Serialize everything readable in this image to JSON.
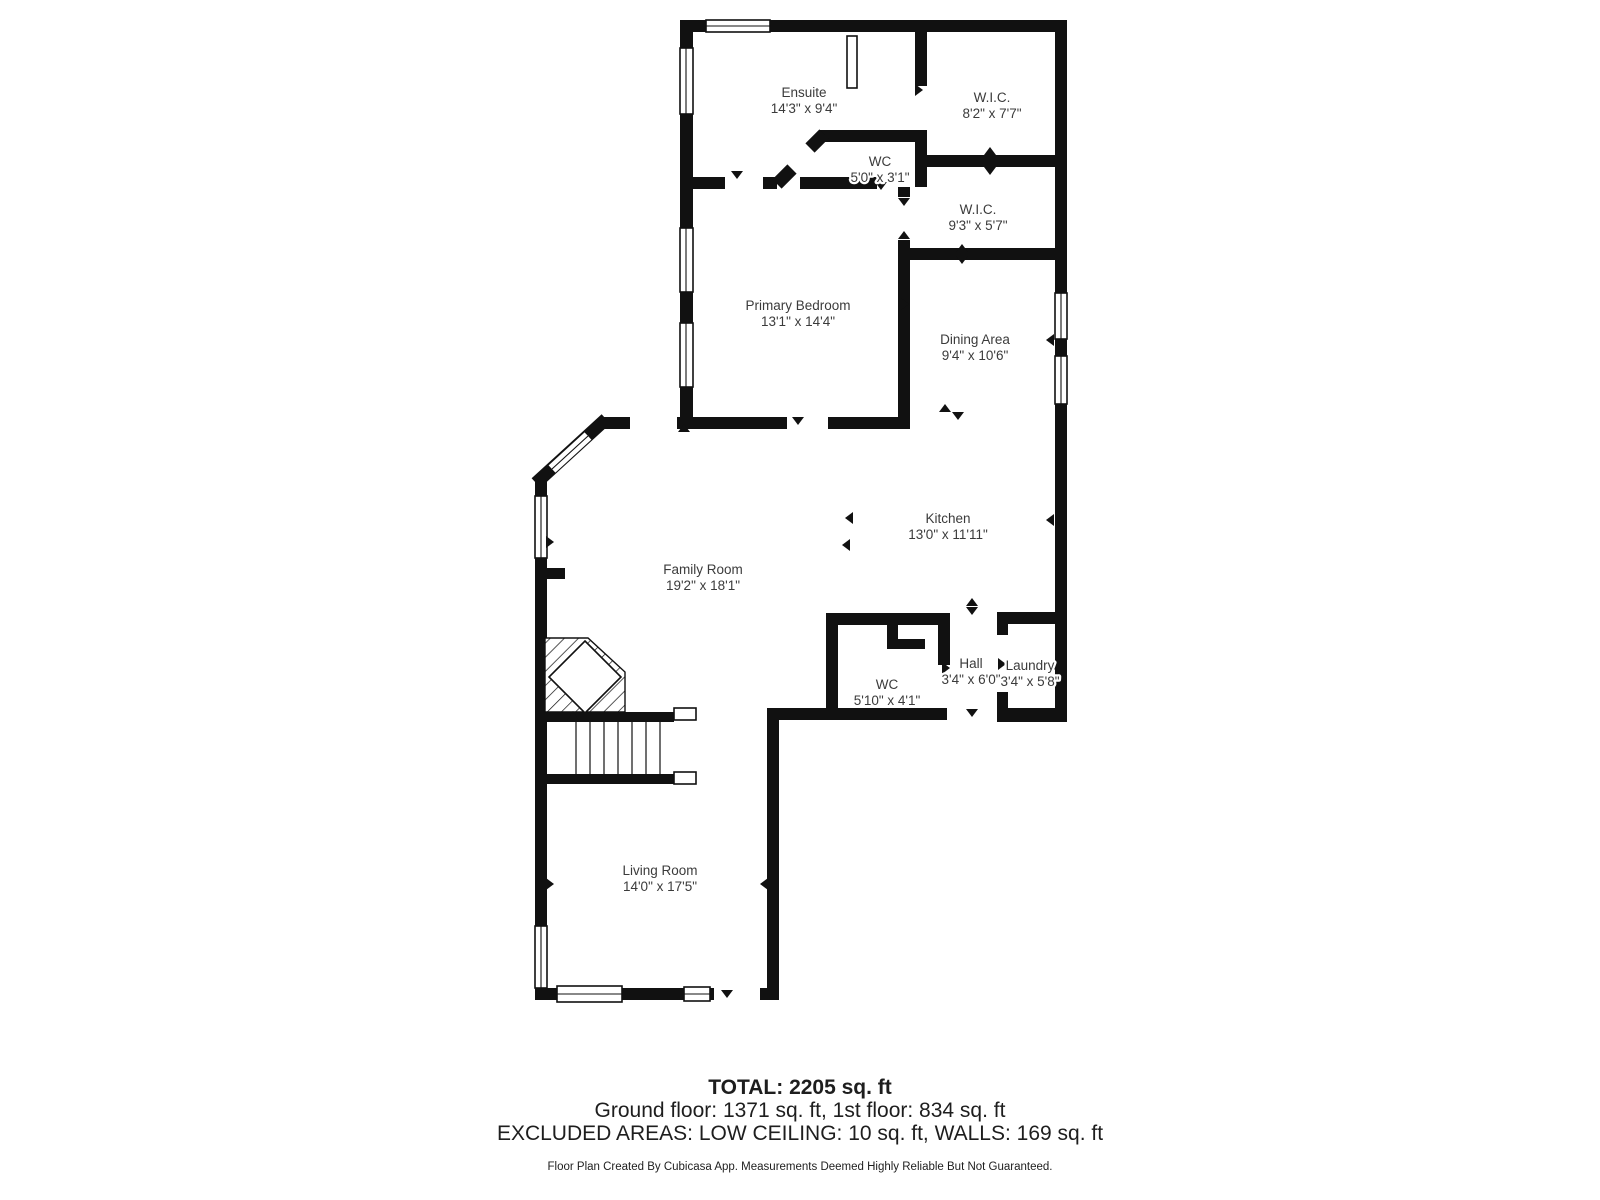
{
  "floorplan": {
    "colors": {
      "wall_color": "#111111",
      "label_color": "#3b3b3b",
      "footer_color": "#1e1e1e"
    },
    "rooms": [
      {
        "name": "Ensuite",
        "dims": "14'3\" x 9'4\""
      },
      {
        "name": "W.I.C.",
        "dims": "8'2\" x 7'7\""
      },
      {
        "name": "WC",
        "dims": "5'0\" x 3'1\""
      },
      {
        "name": "W.I.C.",
        "dims": "9'3\" x 5'7\""
      },
      {
        "name": "Primary Bedroom",
        "dims": "13'1\" x 14'4\""
      },
      {
        "name": "Dining Area",
        "dims": "9'4\" x 10'6\""
      },
      {
        "name": "Kitchen",
        "dims": "13'0\" x 11'11\""
      },
      {
        "name": "Family Room",
        "dims": "19'2\" x 18'1\""
      },
      {
        "name": "WC",
        "dims": "5'10\" x 4'1\""
      },
      {
        "name": "Hall",
        "dims": "3'4\" x 6'0\""
      },
      {
        "name": "Laundry",
        "dims": "3'4\" x 5'8\""
      },
      {
        "name": "Living Room",
        "dims": "14'0\" x 17'5\""
      }
    ],
    "summary": {
      "total": "TOTAL: 2205 sq. ft",
      "floors": "Ground floor: 1371 sq. ft, 1st floor: 834 sq. ft",
      "excluded": "EXCLUDED AREAS: LOW CEILING: 10 sq. ft, WALLS: 169 sq. ft",
      "disclaimer": "Floor Plan Created By Cubicasa App. Measurements Deemed Highly Reliable But Not Guaranteed."
    }
  }
}
